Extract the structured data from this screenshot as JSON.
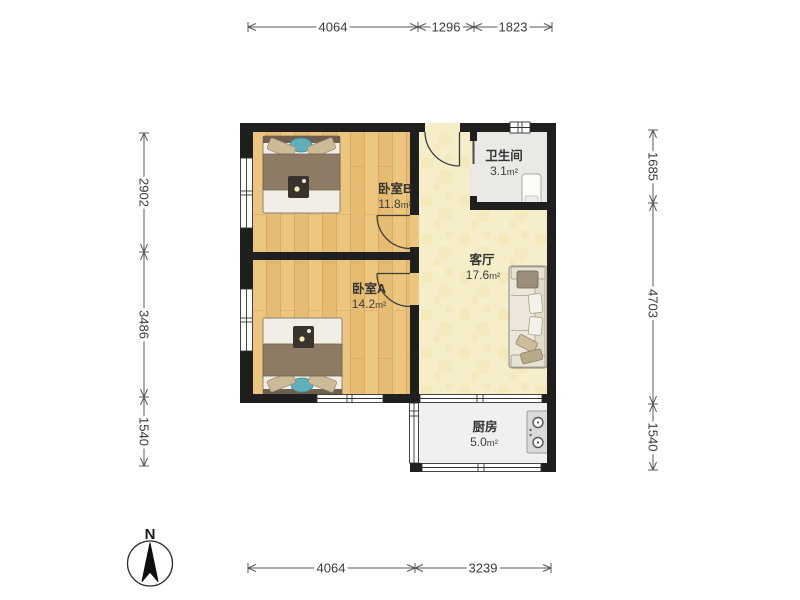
{
  "floorplan": {
    "compass": {
      "label": "N",
      "icon": "north-arrow-icon"
    },
    "rooms": {
      "bedroom_b": {
        "name": "卧室B",
        "area": "11.8",
        "unit": "m²"
      },
      "bedroom_a": {
        "name": "卧室A",
        "area": "14.2",
        "unit": "m²"
      },
      "living": {
        "name": "客厅",
        "area": "17.6",
        "unit": "m²"
      },
      "bathroom": {
        "name": "卫生间",
        "area": "3.1",
        "unit": "m²"
      },
      "kitchen": {
        "name": "厨房",
        "area": "5.0",
        "unit": "m²"
      }
    },
    "dimensions_mm": {
      "top": [
        "4064",
        "1296",
        "1823"
      ],
      "bottom": [
        "4064",
        "3239"
      ],
      "left": [
        "2902",
        "3486",
        "1540"
      ],
      "right": [
        "1685",
        "4703",
        "1540"
      ]
    },
    "icons": {
      "furniture": [
        "double-bed",
        "double-bed",
        "sofa",
        "cooktop",
        "shower-unit"
      ]
    },
    "colors": {
      "wall": "#1f1f1f",
      "wood_floor": "#ecc67f",
      "living_floor": "#f6eec9",
      "tile_floor": "#ebebe7",
      "accent_teal": "#5fb0bc",
      "duvet_brown": "#8d7b66",
      "dim_text": "#3a3a3a"
    }
  }
}
